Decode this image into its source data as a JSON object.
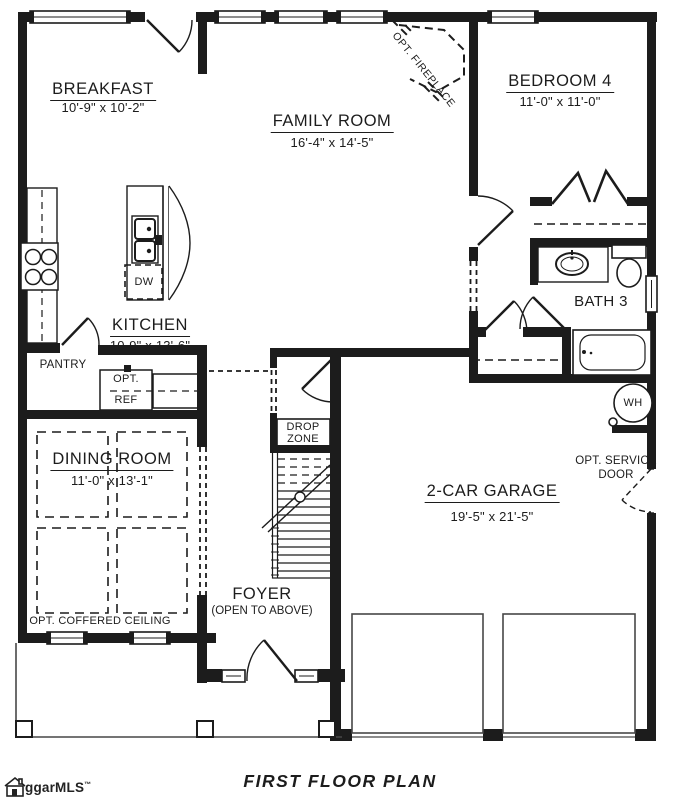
{
  "title": "FIRST FLOOR PLAN",
  "logo": {
    "text": "ggarMLS",
    "tm": "™"
  },
  "rooms": {
    "breakfast": {
      "name": "BREAKFAST",
      "dims": "10'-9\" x 10'-2\""
    },
    "family": {
      "name": "FAMILY ROOM",
      "dims": "16'-4\" x 14'-5\""
    },
    "bedroom4": {
      "name": "BEDROOM 4",
      "dims": "11'-0\" x 11'-0\""
    },
    "kitchen": {
      "name": "KITCHEN",
      "dims": "10-9\" x 13'-6\""
    },
    "dining": {
      "name": "DINING ROOM",
      "dims": "11'-0\" x 13'-1\""
    },
    "garage": {
      "name": "2-CAR GARAGE",
      "dims": "19'-5\" x 21'-5\""
    },
    "bath3": {
      "name": "BATH 3"
    },
    "foyer": {
      "name": "FOYER",
      "sub": "(OPEN TO ABOVE)"
    }
  },
  "labels": {
    "pantry": "PANTRY",
    "dw": "DW",
    "opt_ref_line1": "OPT.",
    "opt_ref_line2": "REF",
    "drop_zone_line1": "DROP",
    "drop_zone_line2": "ZONE",
    "wh": "WH",
    "opt_fireplace": "OPT. FIREPLACE",
    "opt_service_line1": "OPT. SERVICE",
    "opt_service_line2": "DOOR",
    "opt_coffered": "OPT. COFFERED CEILING"
  },
  "colors": {
    "line": "#1c1c1c",
    "background": "#ffffff"
  }
}
